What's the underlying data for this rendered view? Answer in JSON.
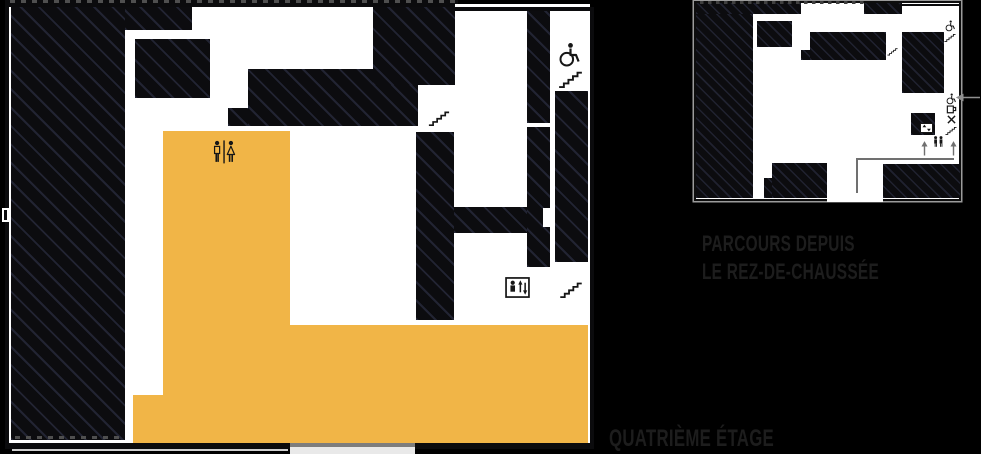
{
  "colors": {
    "background": "#000000",
    "highlight": "#F1B547",
    "label_text": "#1d1d1d",
    "map_white": "#ffffff",
    "hatch_base": "#0c0c0f",
    "path_gray": "#707070",
    "icon_dark": "#161616"
  },
  "labels": {
    "route_caption_line1": "PARCOURS DEPUIS",
    "route_caption_line2": "LE REZ-DE-CHAUSSÉE",
    "floor_label": "QUATRIÈME ÉTAGE"
  },
  "main_map": {
    "name": "quatrieme-etage-plan",
    "icons": [
      "restrooms",
      "wheelchair-access",
      "stairs",
      "stairs",
      "stairs",
      "elevator"
    ]
  },
  "mini_map": {
    "name": "parcours-depuis-le-rez-de-chaussee",
    "icons": [
      "wheelchair-access",
      "stairs",
      "stairs",
      "wheelchair-access",
      "cafe",
      "restaurant",
      "stairs",
      "restrooms",
      "elevator",
      "entrance-arrow",
      "route-up-arrows"
    ]
  }
}
